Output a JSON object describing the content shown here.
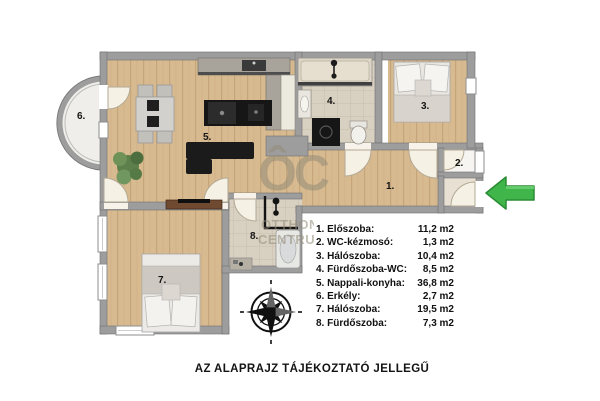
{
  "plan": {
    "room_labels": {
      "r1": "1.",
      "r2": "2.",
      "r3": "3.",
      "r4": "4.",
      "r5": "5.",
      "r6": "6.",
      "r7": "7.",
      "r8": "8."
    }
  },
  "legend": {
    "items": [
      {
        "label": "1. Előszoba:",
        "area": "11,2 m2"
      },
      {
        "label": "2. WC-kézmosó:",
        "area": "1,3 m2"
      },
      {
        "label": "3. Hálószoba:",
        "area": "10,4 m2"
      },
      {
        "label": "4. Fürdőszoba-WC:",
        "area": "8,5 m2"
      },
      {
        "label": "5. Nappali-konyha:",
        "area": "36,8 m2"
      },
      {
        "label": "6. Erkély:",
        "area": "2,7 m2"
      },
      {
        "label": "7. Hálószoba:",
        "area": "19,5 m2"
      },
      {
        "label": "8. Fürdőszoba:",
        "area": "7,3 m2"
      }
    ]
  },
  "watermark": {
    "logo": "ÔC",
    "line1": "OTTHON",
    "line2": "CENTRUM"
  },
  "caption": "AZ ALAPRAJZ TÁJÉKOZTATÓ JELLEGŰ",
  "colors": {
    "wall_gray": "#9d9d9d",
    "wood_floor": "#d8ba90",
    "tile_floor": "#d8d0c0",
    "arrow_green": "#3fb54a",
    "watermark_gray": "#948a76",
    "compass_black": "#111111"
  }
}
